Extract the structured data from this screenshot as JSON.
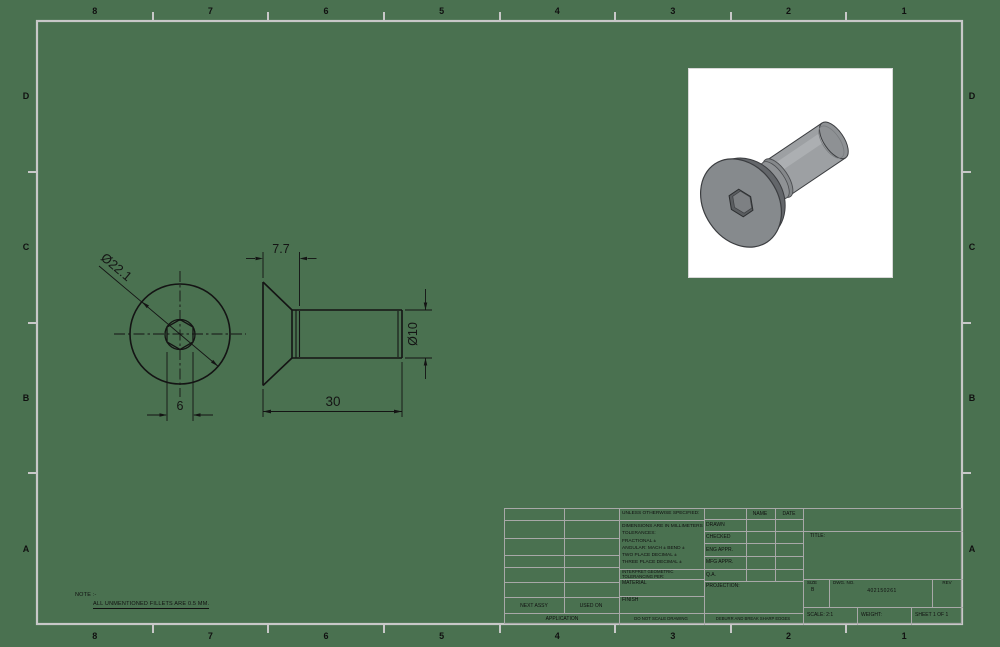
{
  "sheet": {
    "background_color": "#4a7150",
    "border_color": "#c8c8c8",
    "zone_columns": [
      "8",
      "7",
      "6",
      "5",
      "4",
      "3",
      "2",
      "1"
    ],
    "zone_rows": [
      "D",
      "C",
      "B",
      "A"
    ]
  },
  "note": {
    "line1": "NOTE :-",
    "line2": "ALL UNMENTIONED FILLETS ARE 0.5 MM."
  },
  "views": {
    "front": {
      "head_diameter_label": "Ø22.1",
      "hex_width_label": "6"
    },
    "side": {
      "head_length_label": "7.7",
      "overall_length_label": "30",
      "shank_diameter_label": "Ø10"
    }
  },
  "title_block": {
    "spec_header": "UNLESS OTHERWISE SPECIFIED:",
    "spec_lines": [
      "DIMENSIONS ARE IN MILLIMETERS",
      "TOLERANCES:",
      "FRACTIONAL ±",
      "ANGULAR: MACH ±   BEND ±",
      "TWO PLACE DECIMAL    ±",
      "THREE PLACE DECIMAL  ±"
    ],
    "interpret_line1": "INTERPRET GEOMETRIC",
    "interpret_line2": "TOLERANCING PER:",
    "material_label": "MATERIAL",
    "finish_label": "FINISH",
    "do_not_scale": "DO NOT SCALE DRAWING",
    "deburr": "DEBURR AND BREAK SHARP EDGES",
    "name_header": "NAME",
    "date_header": "DATE",
    "approval_rows": [
      "DRAWN",
      "CHECKED",
      "ENG APPR.",
      "MFG APPR.",
      "Q.A."
    ],
    "projection_label": "PROJECTION:",
    "title_label": "TITLE:",
    "size_label": "SIZE",
    "size_value": "B",
    "dwg_label": "DWG.  NO.",
    "dwg_number": "402150261",
    "rev_label": "REV",
    "scale_label": "SCALE: 2:1",
    "weight_label": "WEIGHT:",
    "sheet_label": "SHEET 1 OF 1",
    "next_assy": "NEXT ASSY",
    "used_on": "USED ON",
    "application": "APPLICATION"
  }
}
